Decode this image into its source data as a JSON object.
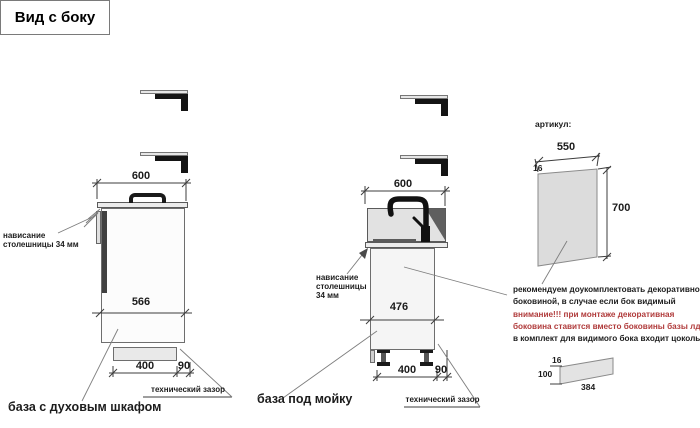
{
  "page": {
    "title": "Вид с боку"
  },
  "colors": {
    "warning_red": "#b03b3b",
    "panel_gray": "#dcdcdc",
    "line_gray": "#3d3d3d"
  },
  "left_cabinet": {
    "name": "база с духовым шкафом",
    "dim_top_width": "600",
    "dim_inner": "566",
    "dim_plinth": "400",
    "dim_gap": "90",
    "overhang_line1": "нависание",
    "overhang_line2": "столешницы 34 мм",
    "tech_gap_label": "технический зазор"
  },
  "sink_cabinet": {
    "name": "база под мойку",
    "dim_top_width": "600",
    "dim_inner": "476",
    "dim_plinth": "400",
    "dim_gap": "90",
    "overhang_line1": "нависание",
    "overhang_line2": "столешницы",
    "overhang_line3": "34 мм",
    "tech_gap_label": "технический зазор"
  },
  "side_panel": {
    "heading": "артикул:",
    "dim_width": "550",
    "dim_thickness": "16",
    "dim_height": "700",
    "note_line1": "рекомендуем доукомплектовать декоративной",
    "note_line2": "боковиной, в случае если бок видимый",
    "note_line3": "внимание!!! при монтаже декоративная",
    "note_line4": "боковина ставится вместо боковины базы лдсп",
    "note_line5": "в комплект для видимого бока входит цоколь:"
  },
  "plinth_item": {
    "dim_thickness": "16",
    "dim_height": "100",
    "dim_length": "384"
  }
}
